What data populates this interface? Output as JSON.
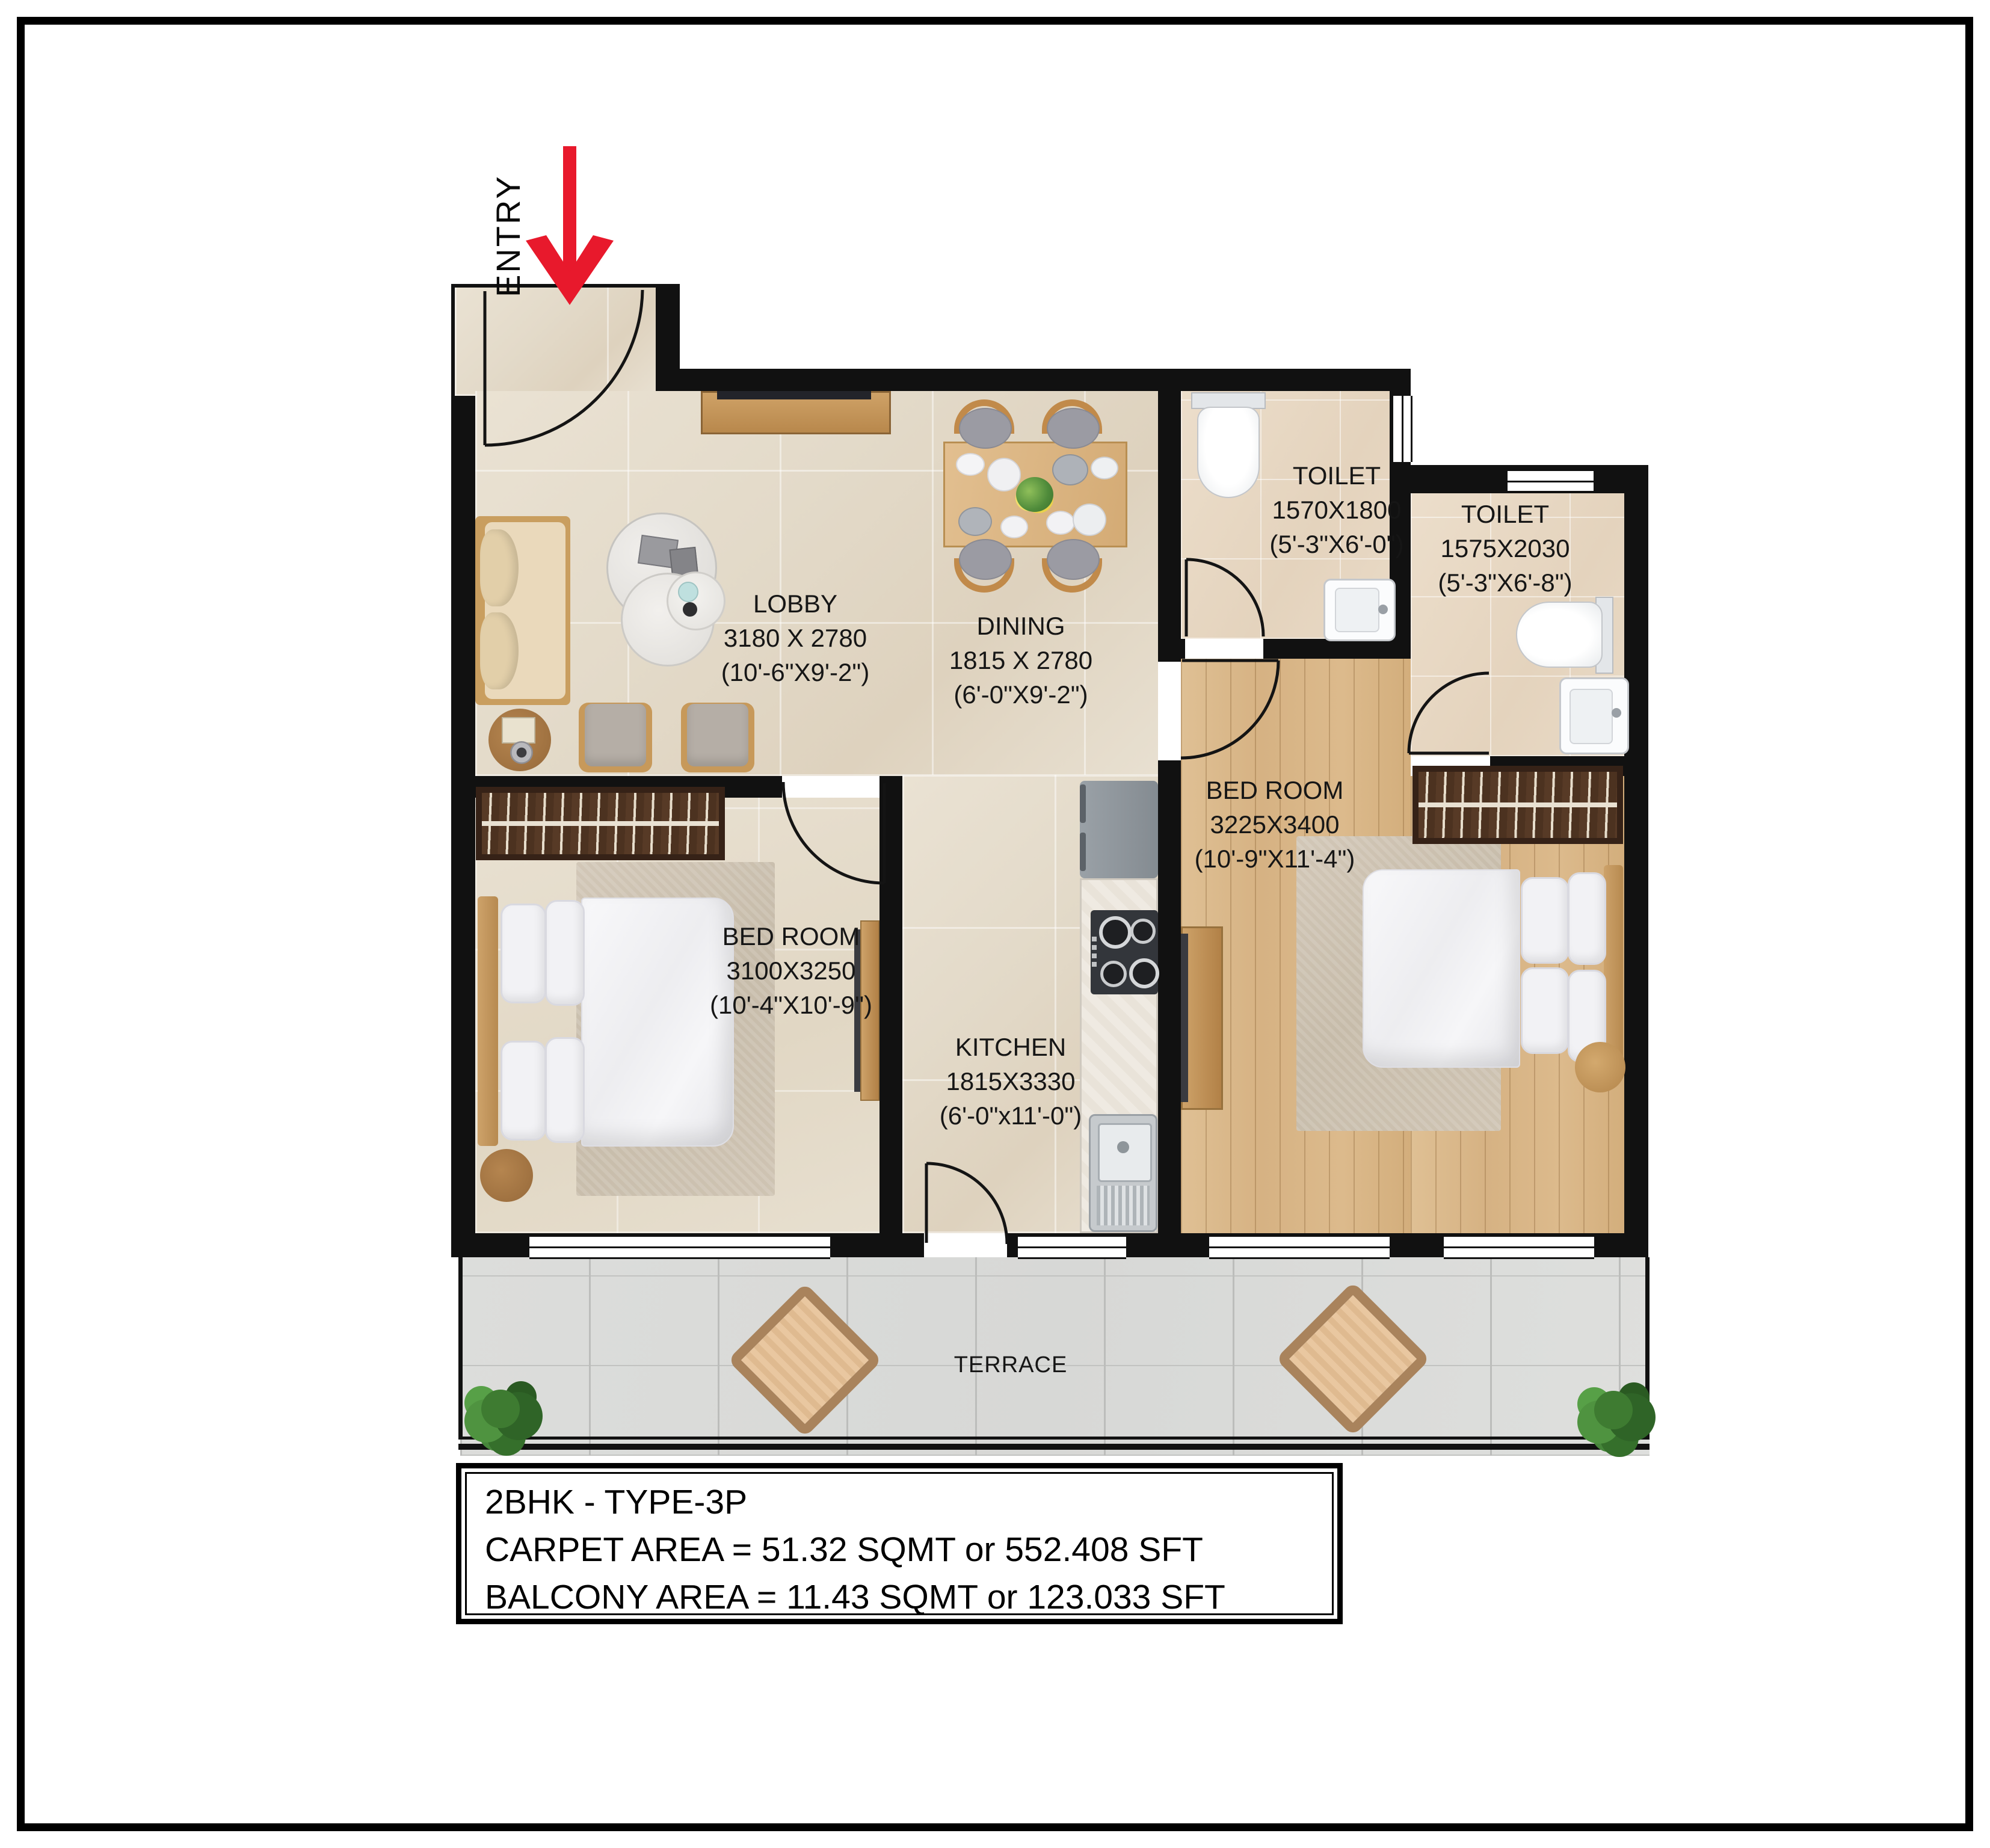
{
  "entry": {
    "label": "ENTRY"
  },
  "rooms": [
    {
      "id": "lobby",
      "name": "LOBBY",
      "dim_mm": "3180 X 2780",
      "dim_ft": "(10'-6\"X9'-2\")"
    },
    {
      "id": "dining",
      "name": "DINING",
      "dim_mm": "1815 X 2780",
      "dim_ft": "(6'-0\"X9'-2\")"
    },
    {
      "id": "kitchen",
      "name": "KITCHEN",
      "dim_mm": "1815X3330",
      "dim_ft": "(6'-0\"x11'-0\")"
    },
    {
      "id": "toilet-1",
      "name": "TOILET",
      "dim_mm": "1570X1800",
      "dim_ft": "(5'-3\"X6'-0\")"
    },
    {
      "id": "toilet-2",
      "name": "TOILET",
      "dim_mm": "1575X2030",
      "dim_ft": "(5'-3\"X6'-8\")"
    },
    {
      "id": "bedroom-right",
      "name": "BED ROOM",
      "dim_mm": "3225X3400",
      "dim_ft": "(10'-9\"X11'-4\")"
    },
    {
      "id": "bedroom-left",
      "name": "BED ROOM",
      "dim_mm": "3100X3250",
      "dim_ft": "(10'-4\"X10'-9\")"
    },
    {
      "id": "terrace",
      "name": "TERRACE"
    }
  ],
  "info_box": {
    "title": "2BHK - TYPE-3P",
    "carpet": "CARPET AREA = 51.32 SQMT or 552.408 SFT",
    "balcony": "BALCONY AREA = 11.43 SQMT or 123.033 SFT"
  },
  "colors": {
    "wall": "#111111",
    "entry_arrow_red": "#e8192c",
    "travertine_floor": "#e5dccb",
    "wood_floor": "#d9b788",
    "toilet_floor": "#e8d9c5",
    "terrace_tile": "#dadbd8",
    "wardrobe_wood": "#4c3220",
    "furniture_wood": "#c49a62"
  }
}
